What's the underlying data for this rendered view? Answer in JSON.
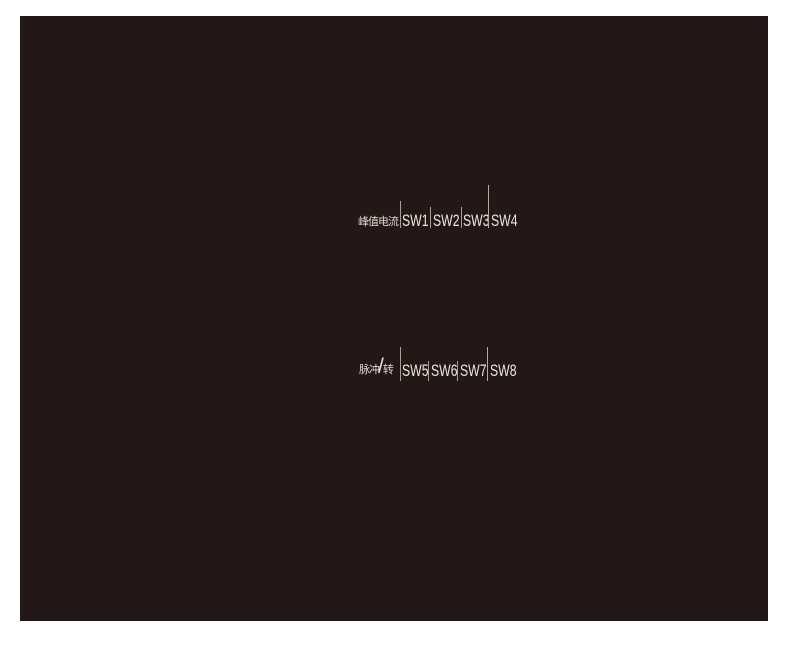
{
  "page": {
    "background_color": "#ffffff"
  },
  "panel": {
    "background_color": "#231815",
    "switch_text_color": "#eae7e3",
    "label_text_color": "#ddd8d3",
    "separator_color": "#a89f99"
  },
  "rows": [
    {
      "id": "peak-current",
      "label": "峰值电流",
      "switches": [
        "SW1",
        "SW2",
        "SW3",
        "SW4"
      ]
    },
    {
      "id": "pulses-per-revolution",
      "label_prefix": "脉冲",
      "label_slash": "/",
      "label_suffix": "转",
      "switches": [
        "SW5",
        "SW6",
        "SW7",
        "SW8"
      ]
    }
  ]
}
